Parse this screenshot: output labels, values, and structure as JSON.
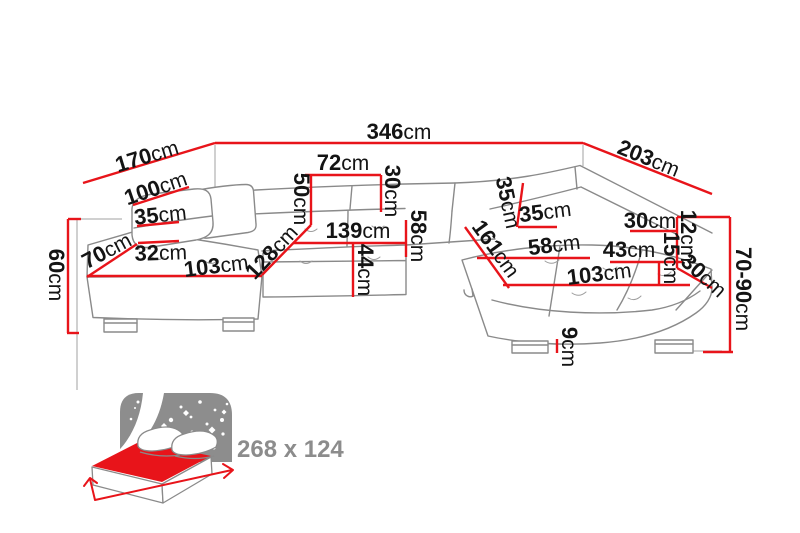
{
  "diagram_labels": {
    "d346": {
      "num": "346",
      "unit": "cm"
    },
    "d170": {
      "num": "170",
      "unit": "cm"
    },
    "d203": {
      "num": "203",
      "unit": "cm"
    },
    "d100": {
      "num": "100",
      "unit": "cm"
    },
    "d35_left": {
      "num": "35",
      "unit": "cm"
    },
    "d70": {
      "num": "70",
      "unit": "cm"
    },
    "d32": {
      "num": "32",
      "unit": "cm"
    },
    "d103_left": {
      "num": "103",
      "unit": "cm"
    },
    "d128": {
      "num": "128",
      "unit": "cm"
    },
    "d60": {
      "num": "60",
      "unit": "cm"
    },
    "d50": {
      "num": "50",
      "unit": "cm"
    },
    "d72": {
      "num": "72",
      "unit": "cm"
    },
    "d30_backrest": {
      "num": "30",
      "unit": "cm"
    },
    "d139": {
      "num": "139",
      "unit": "cm"
    },
    "d58_seat": {
      "num": "58",
      "unit": "cm"
    },
    "d44": {
      "num": "44",
      "unit": "cm"
    },
    "d35_tilt": {
      "num": "35",
      "unit": "cm"
    },
    "d35_corner": {
      "num": "35",
      "unit": "cm"
    },
    "d161": {
      "num": "161",
      "unit": "cm"
    },
    "d58_right": {
      "num": "58",
      "unit": "cm"
    },
    "d103_right": {
      "num": "103",
      "unit": "cm"
    },
    "d30_right": {
      "num": "30",
      "unit": "cm"
    },
    "d12": {
      "num": "12",
      "unit": "cm"
    },
    "d15": {
      "num": "15",
      "unit": "cm"
    },
    "d43": {
      "num": "43",
      "unit": "cm"
    },
    "d30_cut": {
      "num": "30",
      "unit": "cm"
    },
    "d70_90": {
      "num": "70-90",
      "unit": "cm"
    },
    "d9": {
      "num": "9",
      "unit": "cm"
    }
  },
  "sleeping": {
    "size": "268 x 124"
  },
  "colors": {
    "dimension_red": "#e8141a",
    "outline_gray": "#8a8a8a",
    "label_black": "#141414",
    "icon_gray": "#8d8d8d"
  }
}
